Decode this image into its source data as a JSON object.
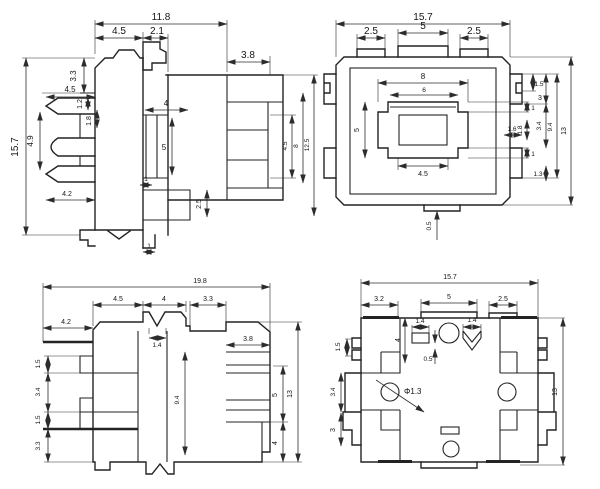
{
  "drawing": {
    "kind": "technical-drawing-4-views",
    "line_color": "#232323",
    "background": "#ffffff"
  },
  "dims": {
    "front": {
      "total_width": "11.8",
      "cap_width": "4.5",
      "step_width": "2.1",
      "right_width": "3.8",
      "collar_height": "3.3",
      "pin_length": "4.5",
      "pin_gap": "1.2",
      "pin_thick": "1.8",
      "pin_pitch": "4.9",
      "total_height": "15.7",
      "tail_length": "4.2",
      "slot_width": "4",
      "slot_height": "5",
      "slot_thick": "1",
      "block_height": "2.5",
      "foot_width": "1",
      "inner_height": "4.5",
      "mid_height": "8",
      "side_height": "12.5"
    },
    "top": {
      "total_width": "15.7",
      "tab_left": "2.5",
      "tab_center": "5",
      "tab_right": "2.5",
      "frame_width": "8",
      "inner_width": "6",
      "frame_height": "5",
      "step_top": "1",
      "step_mid": "1.8",
      "step_bottom": "1",
      "base_width": "4.5",
      "lug_width": "1.6",
      "lug_notch": "1.5",
      "lug_top": "3",
      "lug_gap": "3.4",
      "lug_span": "9.4",
      "total_height": "13",
      "lug_bottom": "1.3",
      "tab_offset": "0.5"
    },
    "side": {
      "total_width": "19.8",
      "top_w1": "4.5",
      "top_w2": "4",
      "top_w3": "3.3",
      "lead_length": "4.2",
      "right_width": "3.8",
      "notch_width": "1.4",
      "term_t1": "1.5",
      "term_gap": "3.4",
      "term_t2": "1.5",
      "base_height": "3.3",
      "body_height": "9.4",
      "term_span": "5",
      "lower_height": "4",
      "total_height": "13"
    },
    "bottom": {
      "total_width": "15.7",
      "top_w1": "3.2",
      "top_w2": "5",
      "top_w3": "2.5",
      "side_tab": "1.5",
      "slot_width": "1.4",
      "slot_offset": "0.5",
      "post_height": "4",
      "mark_width": "1.4",
      "hole_dia": "Φ1.3",
      "side_h1": "3.4",
      "side_h2": "3",
      "total_height": "13"
    }
  }
}
